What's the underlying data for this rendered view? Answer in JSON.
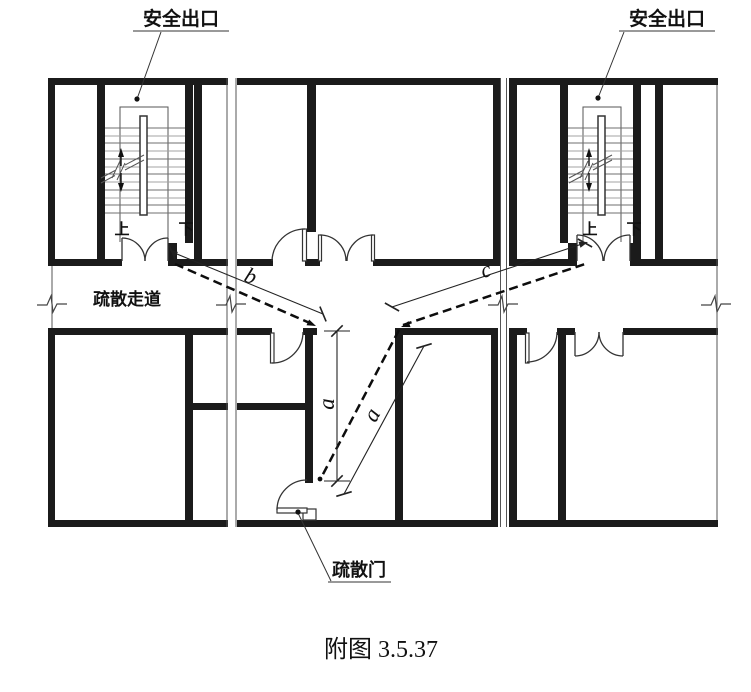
{
  "figure": {
    "caption": "附图 3.5.37"
  },
  "labels": {
    "safety_exit_left": "安全出口",
    "safety_exit_right": "安全出口",
    "evacuation_corridor": "疏散走道",
    "evacuation_door": "疏散门",
    "stair_up_left": "上",
    "stair_down_left": "下",
    "stair_up_right": "上",
    "stair_down_right": "下"
  },
  "dimensions": {
    "corridor_vertical": "a",
    "diagonal_path": "a",
    "path_to_left_exit": "b",
    "path_to_right_exit": "c"
  },
  "colors": {
    "background": "#ffffff",
    "wall": "#1b1b1b",
    "thin_line": "#555555",
    "tread_light": "#a3a3a3",
    "tread_dark": "#6f6f6f",
    "dashed_path": "#0d0d0d"
  }
}
